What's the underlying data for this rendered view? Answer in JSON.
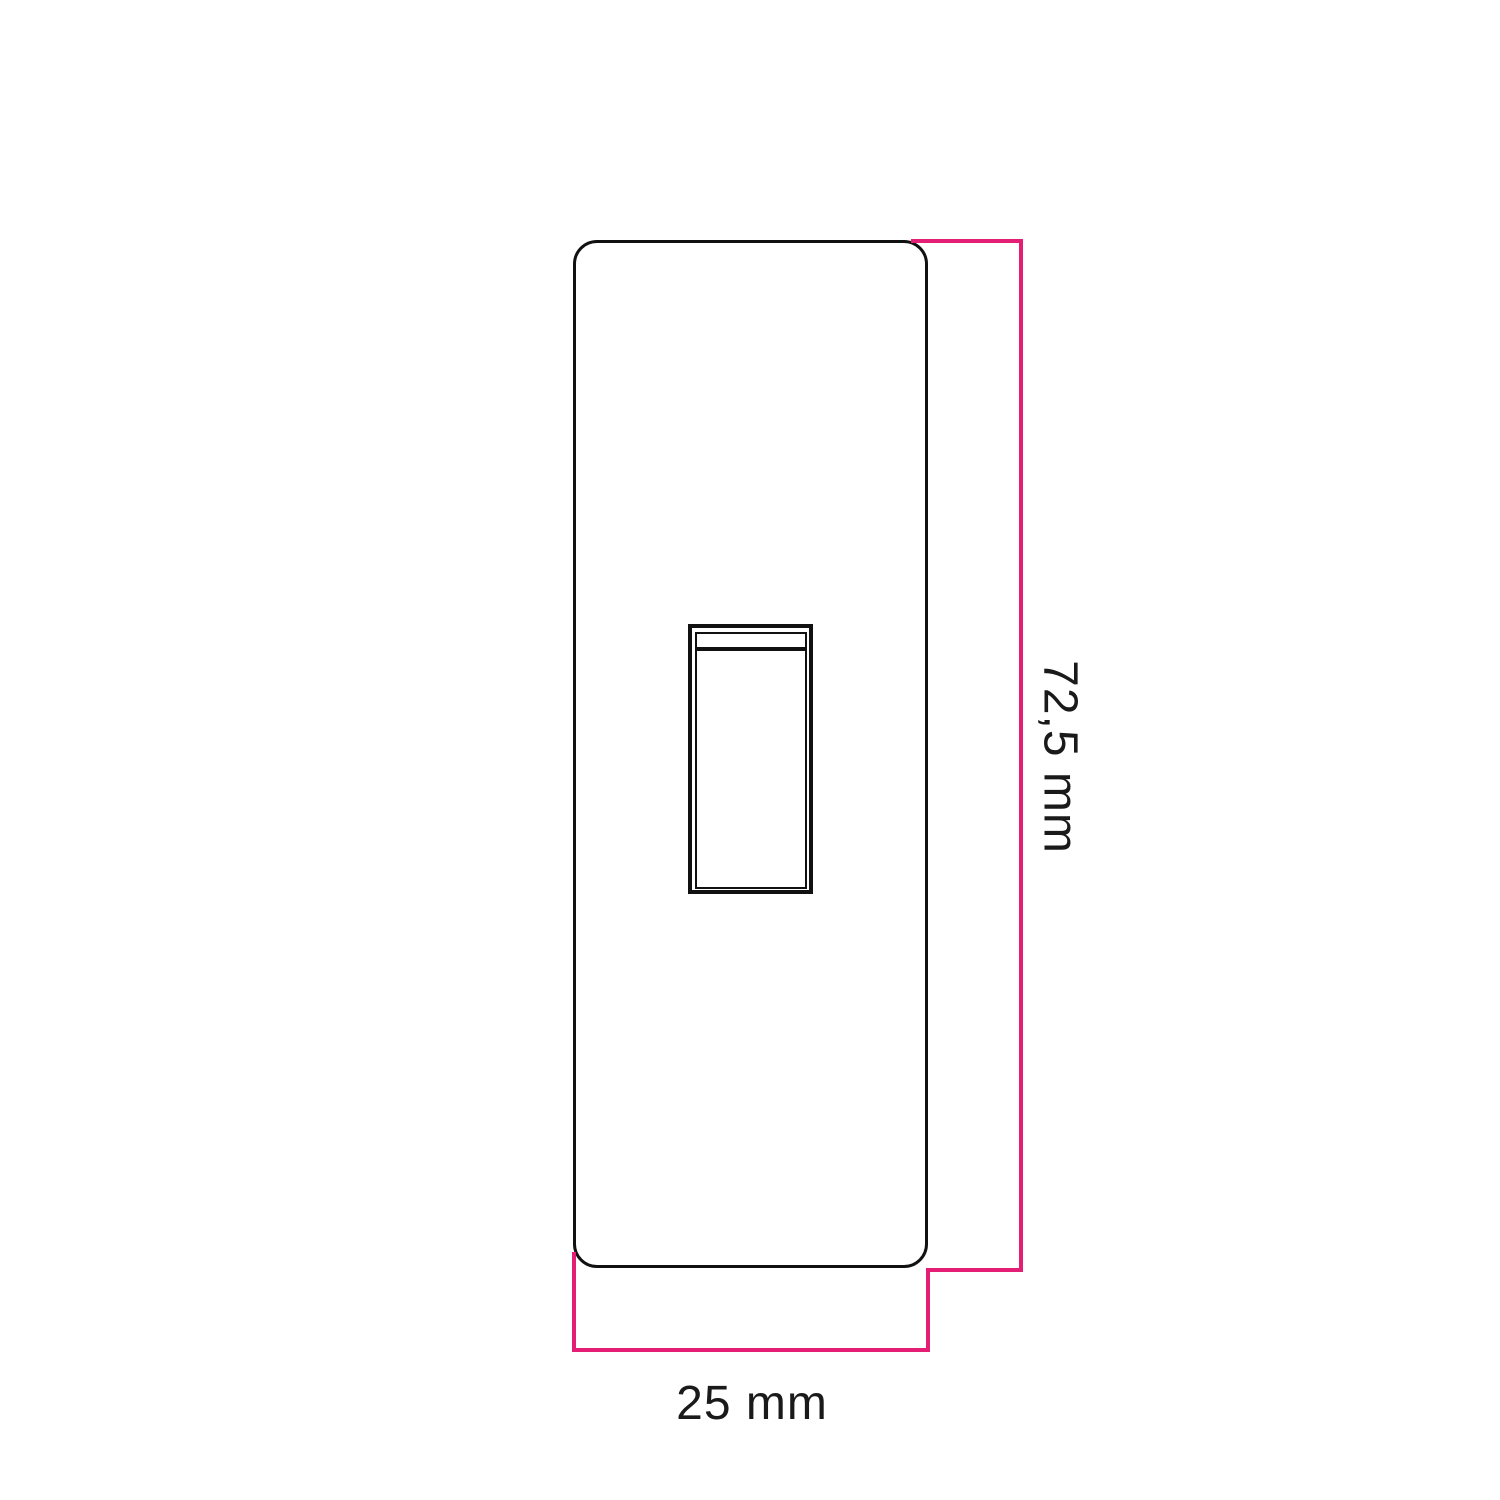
{
  "colors": {
    "background": "#ffffff",
    "outline": "#111111",
    "dimension-line": "#e41e75",
    "text": "#1a1a1a"
  },
  "drawing": {
    "subject": "faceplate-with-rocker-switch",
    "height_dimension": {
      "label": "72,5 mm",
      "orientation": "vertical"
    },
    "width_dimension": {
      "label": "25 mm",
      "orientation": "horizontal"
    }
  }
}
